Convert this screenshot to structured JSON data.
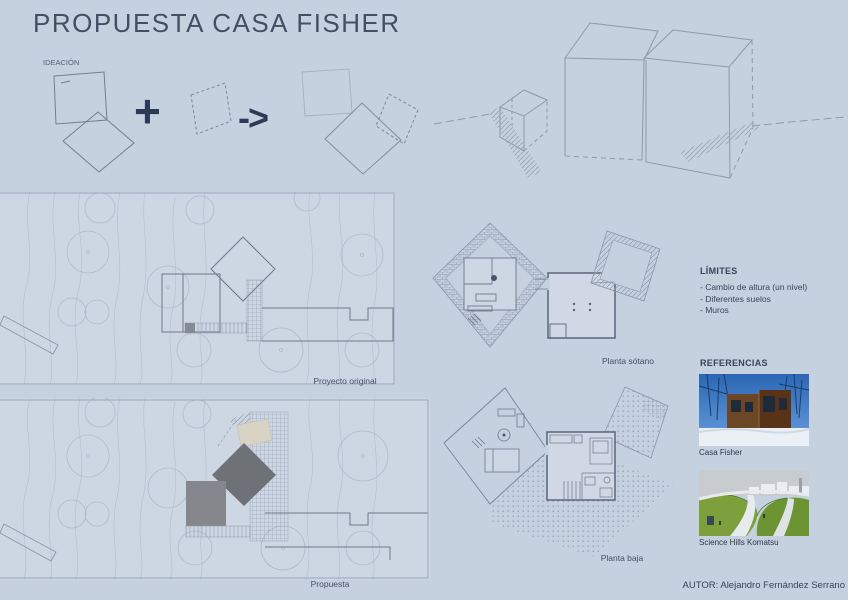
{
  "title": "PROPUESTA CASA FISHER",
  "ideation": {
    "label": "IDEACIÓN",
    "plus_sign": "+",
    "arrow_sign": "->"
  },
  "site_plans": {
    "original_caption": "Proyecto original",
    "proposal_caption": "Propuesta"
  },
  "floor_plans": {
    "basement_caption": "Planta sótano",
    "ground_caption": "Planta baja"
  },
  "limits": {
    "heading": "LÍMITES",
    "items": [
      "- Cambio de altura (un nivel)",
      "- Diferentes suelos",
      "- Muros"
    ]
  },
  "references": {
    "heading": "REFERENCIAS",
    "items": [
      {
        "caption": "Casa Fisher"
      },
      {
        "caption": "Science Hills Komatsu"
      }
    ]
  },
  "author": "AUTOR: Alejandro Fernández Serrano",
  "colors": {
    "background": "#c6d1e0",
    "panel": "#cdd7e4",
    "ink": "#2c3a57",
    "title_text": "#454f63",
    "sketch_line": "#8f99a8",
    "plan_line": "#9aa7ba",
    "building_line": "#6d7889",
    "proposal_fill_gray": "#85878c",
    "proposal_fill_dark": "#6e7176",
    "proposal_fill_beige": "#d8d3c4"
  }
}
